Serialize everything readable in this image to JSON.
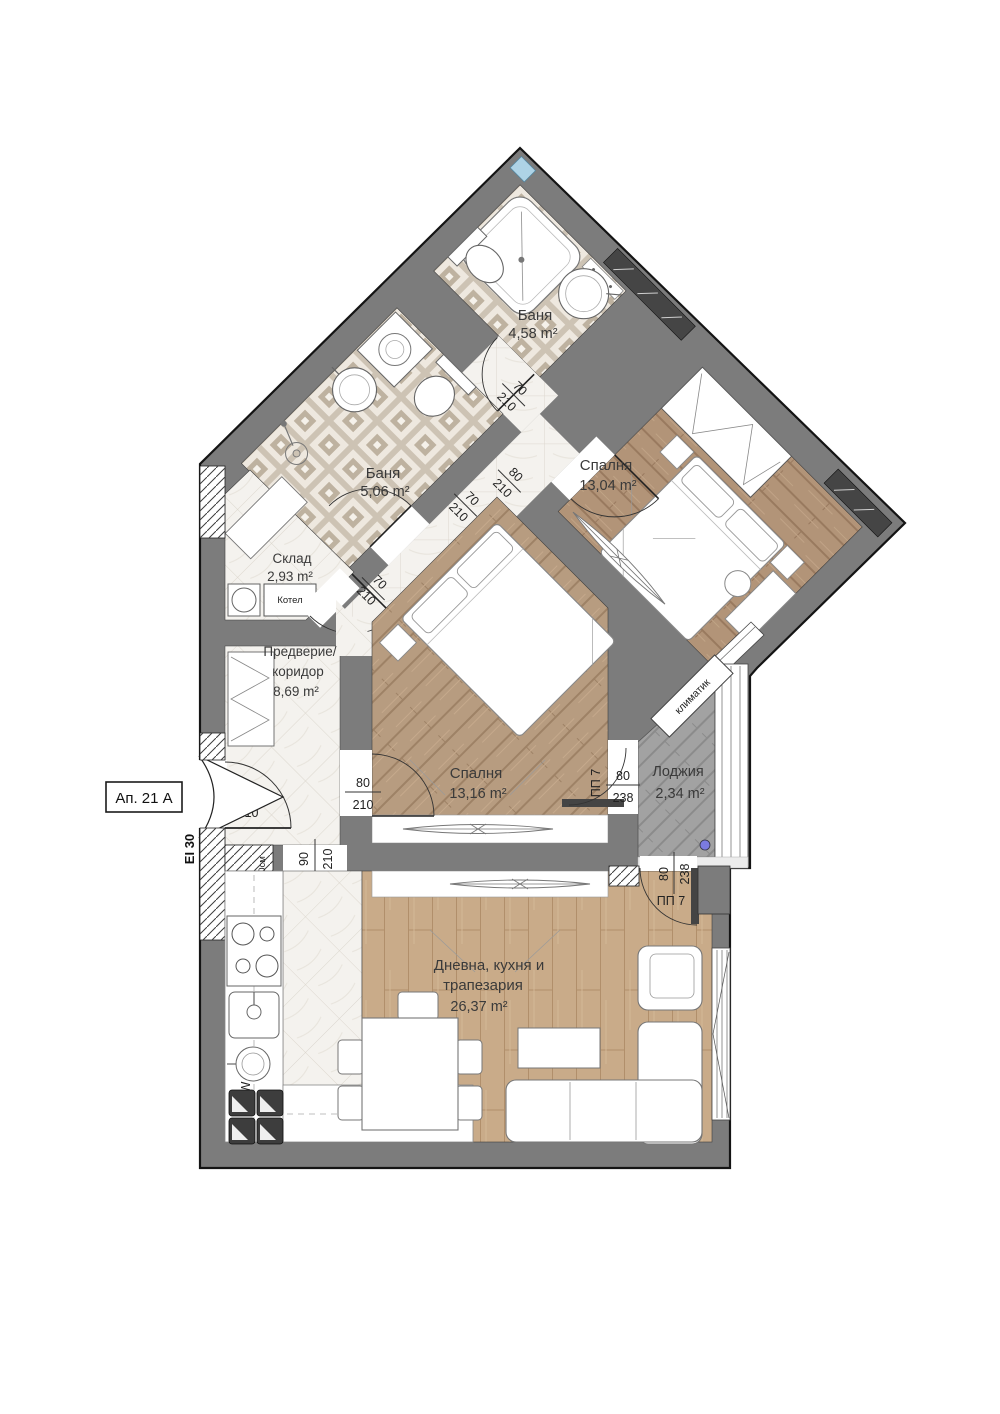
{
  "plan": {
    "rooms": {
      "bath_top": {
        "name": "Баня",
        "area": "4,58 m²"
      },
      "bath_mid": {
        "name": "Баня",
        "area": "5,06 m²"
      },
      "bedroom_right": {
        "name": "Спалня",
        "area": "13,04 m²"
      },
      "storage": {
        "name": "Склад",
        "area": "2,93 m²"
      },
      "hall": {
        "line1": "Предверие/",
        "line2": "коридор",
        "area": "8,69 m²"
      },
      "bedroom_center": {
        "name": "Спалня",
        "area": "13,16 m²"
      },
      "loggia": {
        "name": "Лоджия",
        "area": "2,34 m²"
      },
      "living": {
        "line1": "Дневна, кухня и",
        "line2": "трапезария",
        "area": "26,37 m²"
      }
    },
    "doors": {
      "entrance": {
        "w": "100",
        "h": "210"
      },
      "hall_kitchen": {
        "w": "90",
        "h": "210"
      },
      "bath_top": {
        "w": "70",
        "h": "210"
      },
      "bath_mid": {
        "w": "70",
        "h": "210"
      },
      "storage": {
        "w": "70",
        "h": "210"
      },
      "bedroom_right": {
        "w": "80",
        "h": "210"
      },
      "bedroom_center": {
        "w": "80",
        "h": "210"
      },
      "loggia_bedroom": {
        "label": "ПП 7",
        "w": "80",
        "h": "238"
      },
      "loggia_living": {
        "label": "ПП 7",
        "w": "80",
        "h": "238"
      }
    },
    "annotations": {
      "apartment": "Ап. 21 А",
      "fire_rating": "EI 30",
      "boiler": "Котел",
      "ac_unit": "климатик",
      "dishwasher": "DW",
      "parapet": "Нпарап = 90см"
    },
    "colors": {
      "wall": "#7c7c7c",
      "tile": "#cdc3b4",
      "marble": "#f4f2ee",
      "wood_bedroom": "#b29478",
      "wood_living": "#c9ab89",
      "loggia_floor": "#a2a2a2",
      "accent_blue": "#aed3e6"
    }
  }
}
